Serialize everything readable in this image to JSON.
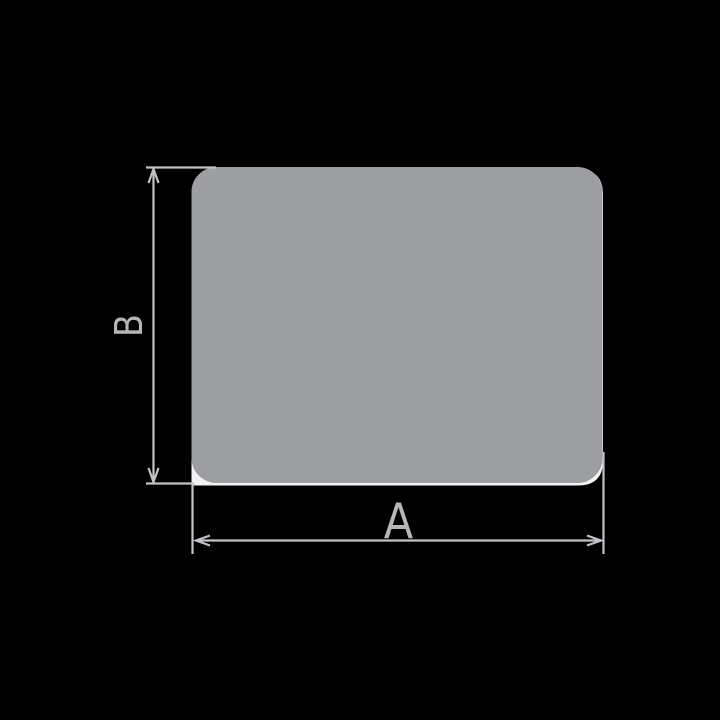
{
  "page": {
    "background": "#000000"
  },
  "drawing": {
    "kind": "technical-dimension-diagram",
    "shape": {
      "description": "rounded rectangle profile",
      "fill": "#9c9ea1",
      "backing_fill": "#f2f2f4"
    },
    "line_color": "#c2c3c6",
    "label_color": "#b5b6b9",
    "dimensions": {
      "width": {
        "label": "A",
        "orientation": "horizontal"
      },
      "height": {
        "label": "B",
        "orientation": "vertical"
      }
    }
  }
}
